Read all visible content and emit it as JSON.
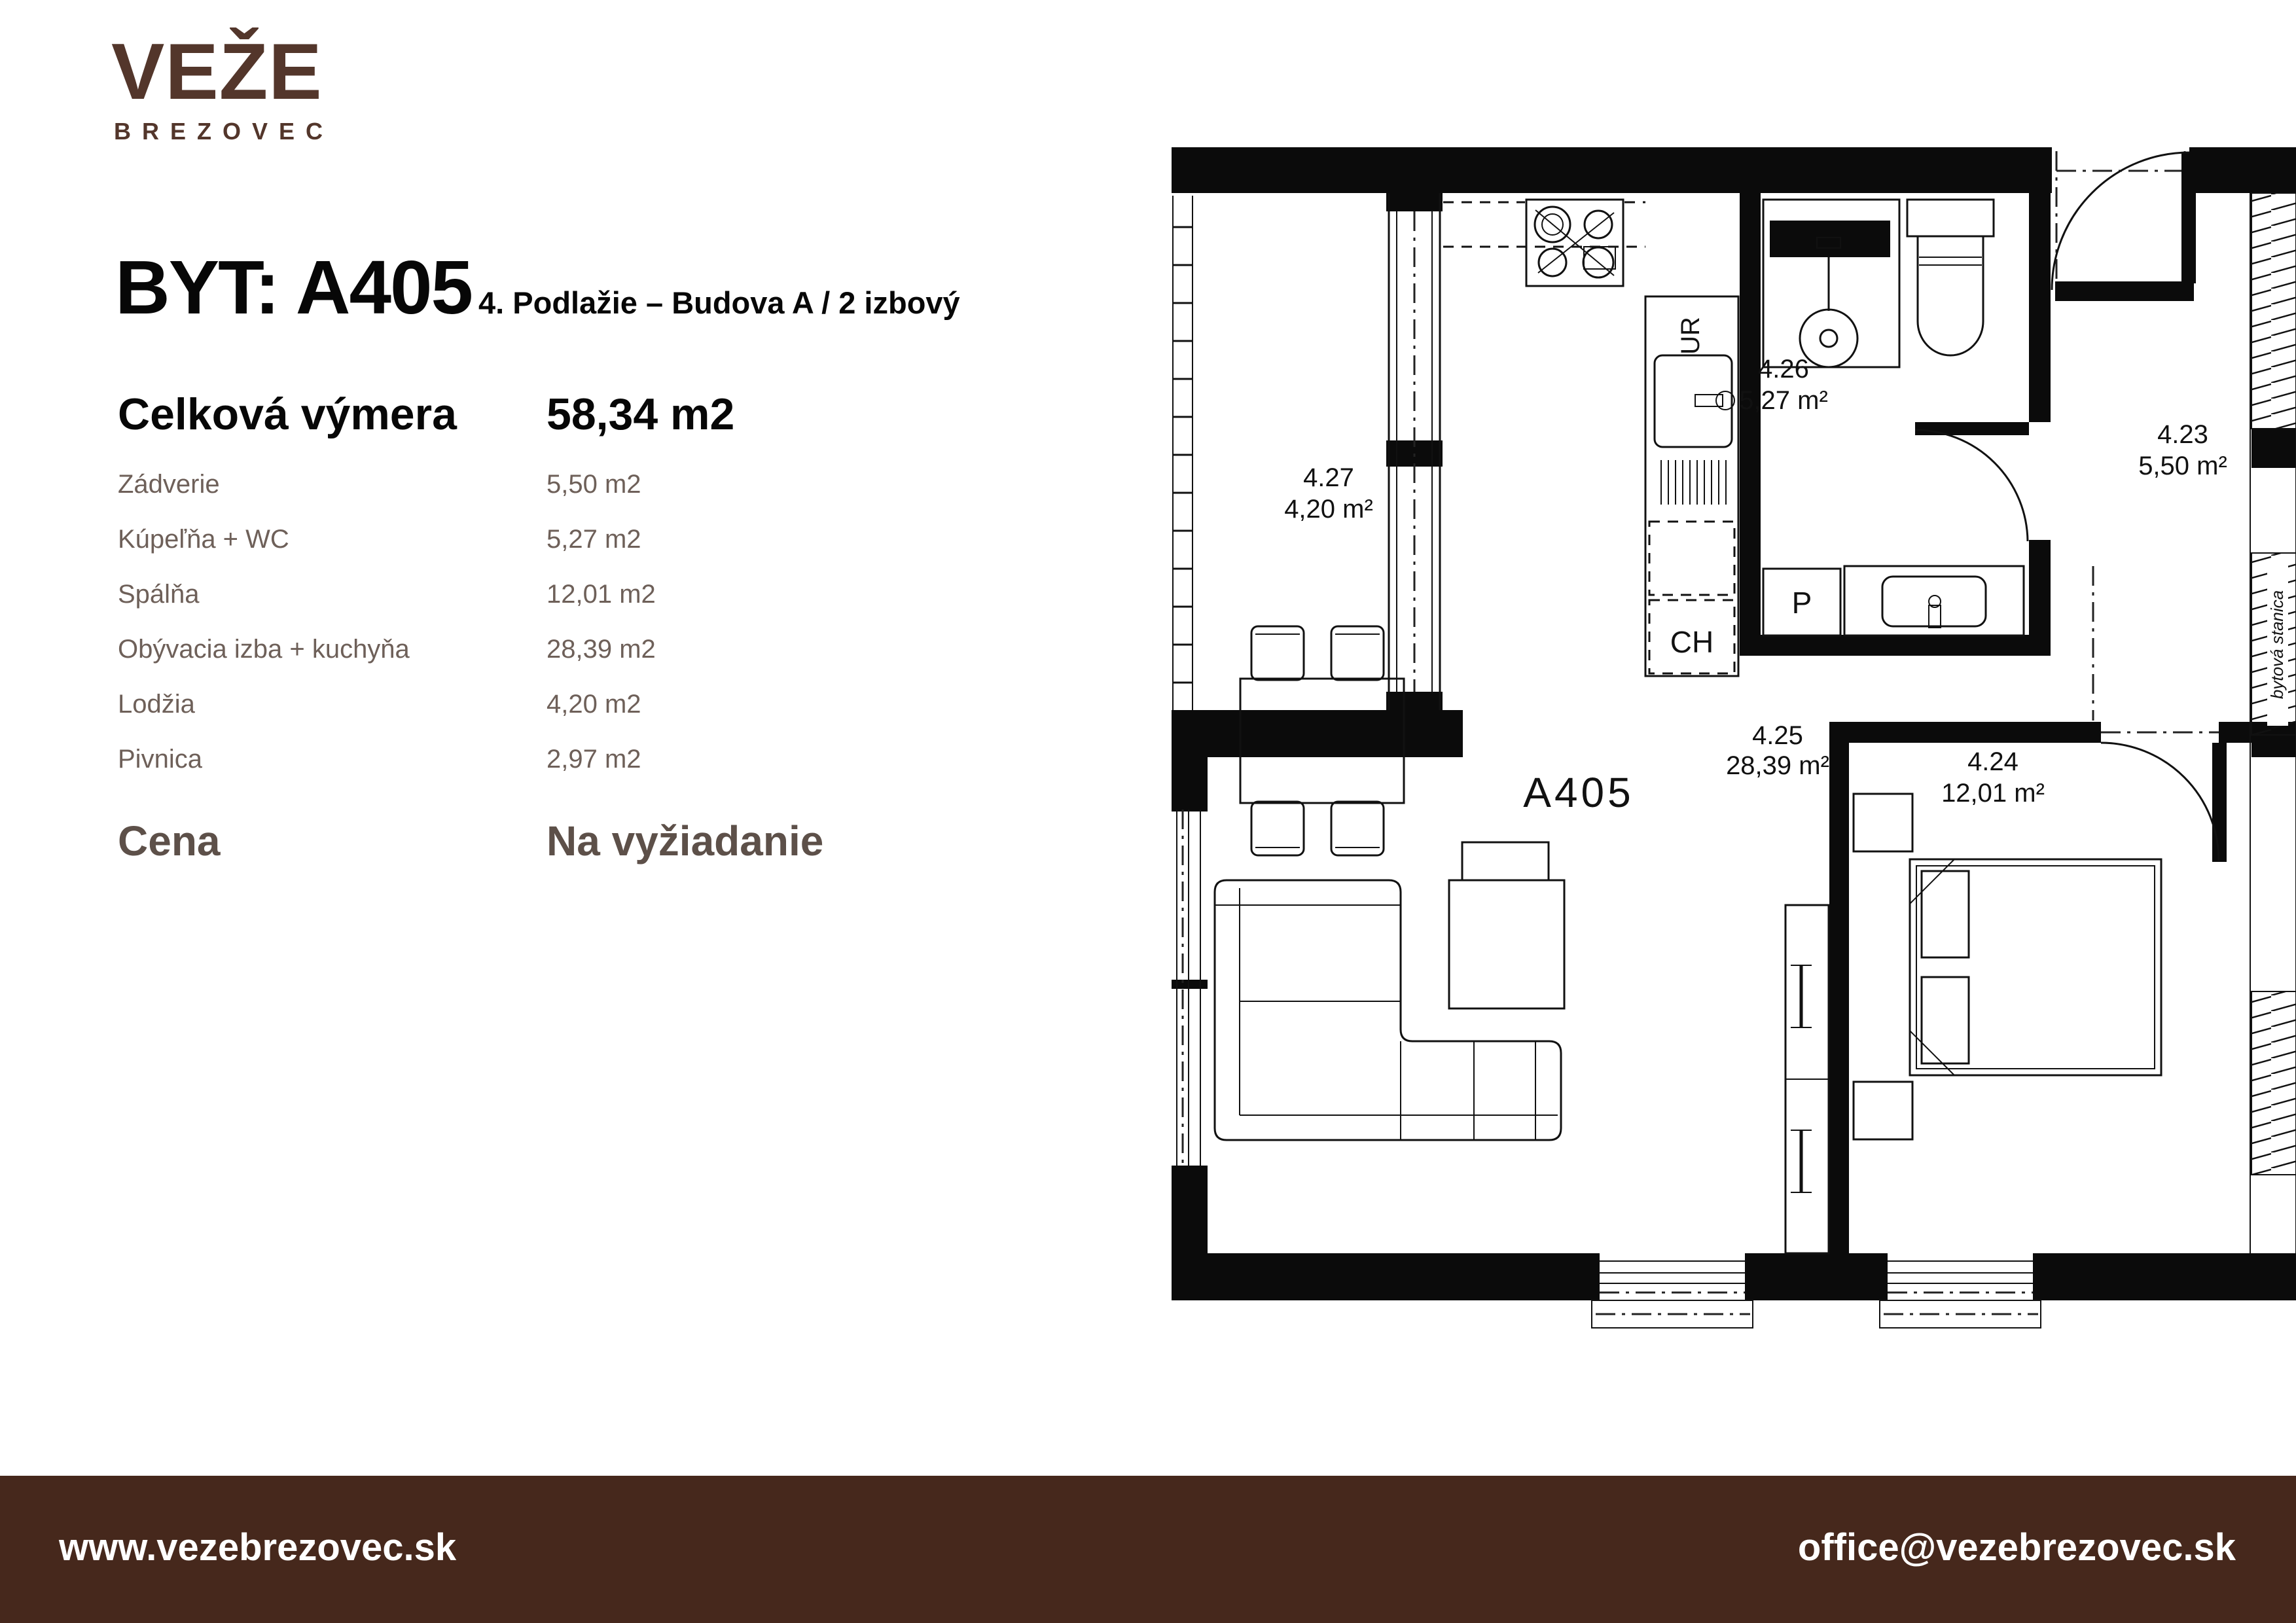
{
  "brand": {
    "logo_main": "VEŽE",
    "logo_sub": "BREZOVEC",
    "color": "#53362b"
  },
  "header": {
    "title": "BYT: A405",
    "subtitle": "4. Podlažie – Budova A / 2 izbový"
  },
  "summary": {
    "label": "Celková výmera",
    "value": "58,34 m2"
  },
  "rooms": [
    {
      "name": "Zádverie",
      "area": "5,50 m2"
    },
    {
      "name": "Kúpeľňa + WC",
      "area": "5,27 m2"
    },
    {
      "name": "Spálňa",
      "area": "12,01 m2"
    },
    {
      "name": "Obývacia izba + kuchyňa",
      "area": "28,39 m2"
    },
    {
      "name": "Lodžia",
      "area": "4,20 m2"
    },
    {
      "name": "Pivnica",
      "area": "2,97 m2"
    }
  ],
  "price": {
    "label": "Cena",
    "value": "Na vyžiadanie"
  },
  "footer": {
    "website": "www.vezebrezovec.sk",
    "email": "office@vezebrezovec.sk",
    "bg": "#46281c"
  },
  "plan": {
    "unit_label": "A405",
    "rooms": [
      {
        "id": "4.27",
        "area": "4,20 m²"
      },
      {
        "id": "4.26",
        "area": "5,27 m²"
      },
      {
        "id": "4.23",
        "area": "5,50 m²"
      },
      {
        "id": "4.25",
        "area": "28,39 m²"
      },
      {
        "id": "4.24",
        "area": "12,01 m²"
      }
    ],
    "markers": {
      "sink": "UR",
      "fridge": "CH",
      "washer": "P",
      "shaft": "bytová stanica"
    }
  }
}
